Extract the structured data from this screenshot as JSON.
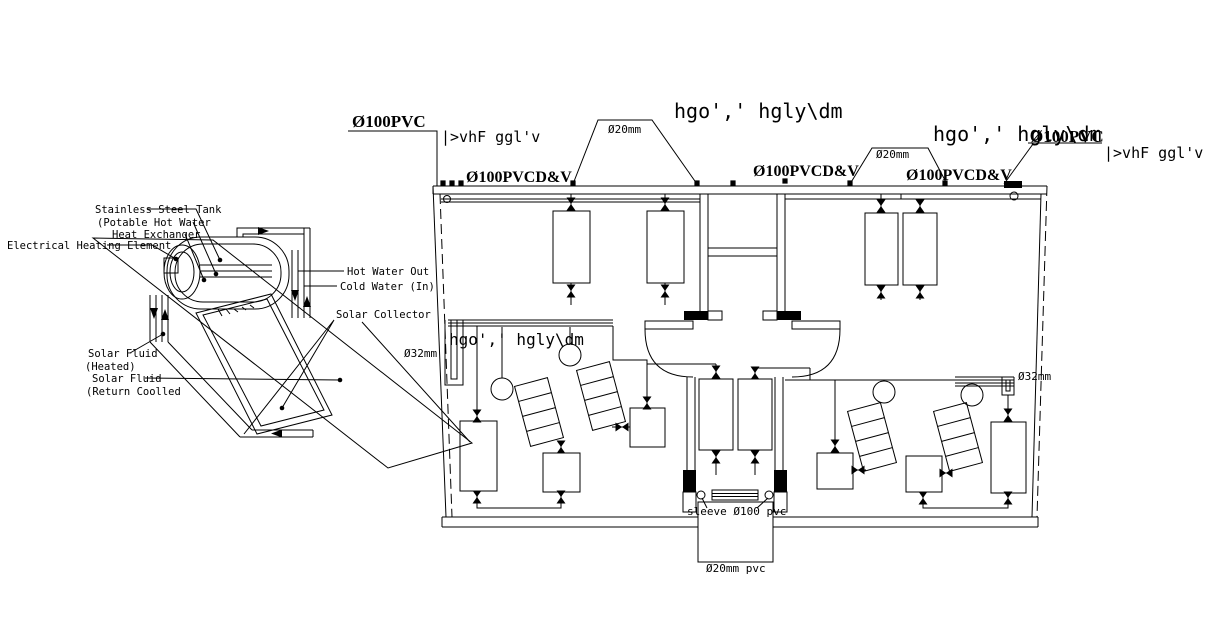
{
  "colors": {
    "line": "#000000",
    "background": "#ffffff"
  },
  "detail": {
    "labels": {
      "tank": "Stainless Steel Tank",
      "potable": "(Potable Hot Water",
      "heat_exchanger": "Heat Exchanger",
      "heating_element": "Electrical Heating Element",
      "hot_water_out": "Hot Water Out",
      "cold_water_in": "Cold Water (In)",
      "solar_collector": "Solar Collector",
      "solar_fluid_a": "Solar Fluid",
      "solar_fluid_a2": "(Heated)",
      "solar_fluid_b": "Solar Fluid",
      "solar_fluid_b2": "(Return Coolled"
    }
  },
  "plan": {
    "labels": {
      "pvc_top_left": "Ø100PVC",
      "vent_left": "|>vhF ggl'v",
      "pvcdv_left": "Ø100PVCD&V",
      "d20_left": "Ø20mm",
      "title_top": "hgo',' hgly\\dm",
      "pvcdv_center": "Ø100PVCD&V",
      "d20_right": "Ø20mm",
      "title_right": "hgo',' hgly\\dm",
      "pvc_top_right": "Ø100PVC",
      "vent_right": "|>vhF ggl'v",
      "pvcdv_right": "Ø100PVCD&V",
      "room_title": "hgo',' hgly\\dm",
      "d32_left": "Ø32mm",
      "d32_right": "Ø32mm",
      "sleeve": "sleeve Ø100 pvc",
      "d20_bottom": "Ø20mm pvc"
    }
  }
}
